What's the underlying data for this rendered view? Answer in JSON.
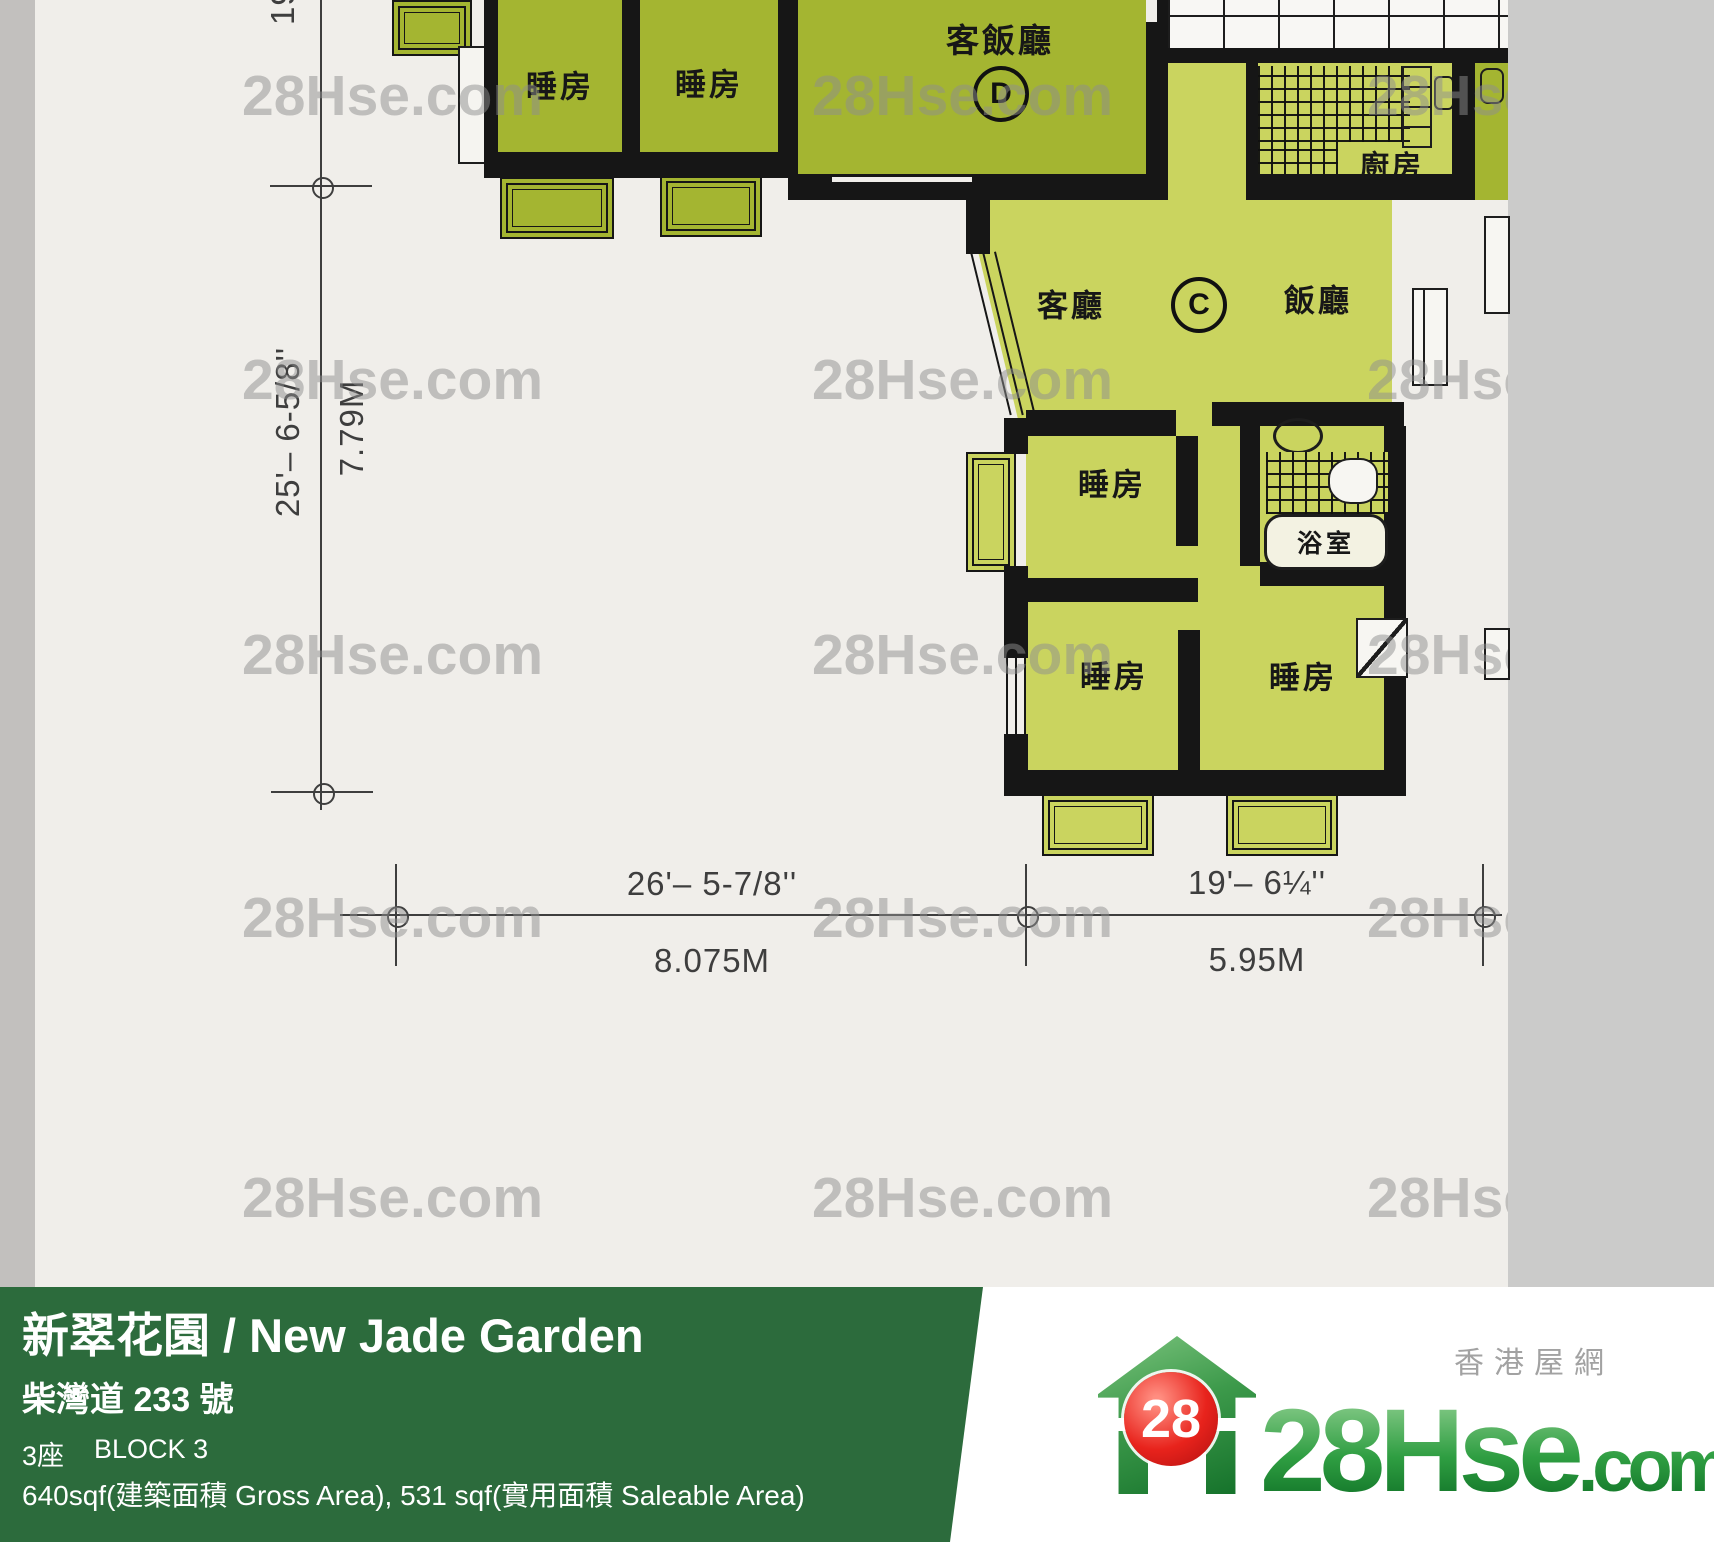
{
  "colors": {
    "paper": "#f0eeea",
    "scan_gray": "#cbcbca",
    "left_strip": "#c2c0be",
    "dark_green": "#a4b531",
    "light_green": "#cad45f",
    "wall": "#161616",
    "footer_green": "#2c6b3c",
    "badge_red": "#e8231c",
    "brand_green": "#2f9e42",
    "dim_text": "#3e3e3e"
  },
  "plan": {
    "rooms": {
      "bedroom": "睡房",
      "living_dining": "客飯廳",
      "living": "客廳",
      "dining": "飯廳",
      "kitchen": "廚房",
      "bathroom": "浴室"
    },
    "units": {
      "c": "C",
      "d": "D"
    }
  },
  "dimensions": {
    "left": {
      "imperial": "25'– 6-5/8''",
      "metric": "7.79M",
      "top_fragment": "19'"
    },
    "bottom": [
      {
        "imperial": "26'– 5-7/8''",
        "metric": "8.075M"
      },
      {
        "imperial": "19'– 6¼''",
        "metric": "5.95M"
      }
    ]
  },
  "watermark": {
    "text": "28Hse.com",
    "rows": [
      63,
      347,
      622,
      885,
      1165
    ],
    "cols": [
      242,
      812,
      1367
    ]
  },
  "footer": {
    "title": "新翠花園 / New Jade Garden",
    "address": "柴灣道 233 號",
    "block_cn": "3座",
    "block_en": "BLOCK 3",
    "area": "640sqf(建築面積 Gross Area), 531 sqf(實用面積 Saleable Area)"
  },
  "logo": {
    "badge": "28",
    "brand": "28Hse",
    "brand_suffix": ".com",
    "tagline": "香港屋網"
  }
}
